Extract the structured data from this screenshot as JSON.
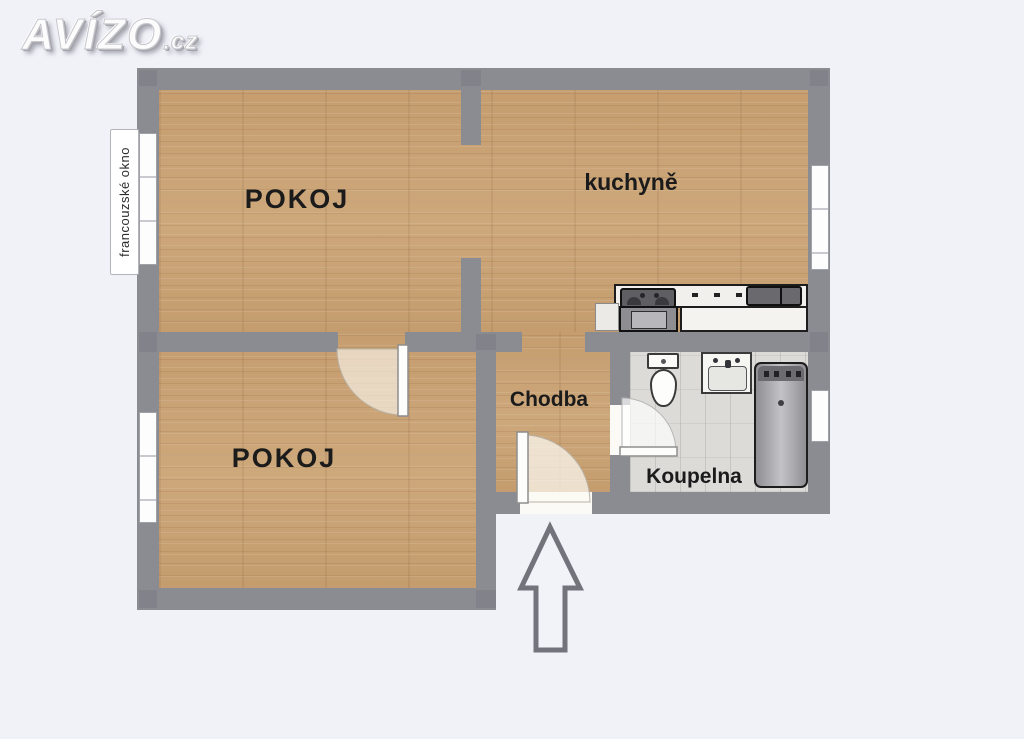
{
  "logo": {
    "name": "AVÍZO",
    "tld": ".cz"
  },
  "plan": {
    "rooms": [
      {
        "id": "pokoj-top",
        "label": "POKOJ"
      },
      {
        "id": "kuchyne",
        "label": "kuchyně"
      },
      {
        "id": "pokoj-bottom",
        "label": "POKOJ"
      },
      {
        "id": "chodba",
        "label": "Chodba"
      },
      {
        "id": "koupelna",
        "label": "Koupelna"
      }
    ],
    "annotations": {
      "french_window": "francouzské okno"
    },
    "colors": {
      "wall": "#8b8b92",
      "wood_floor": "#c7a173",
      "bath_tile": "#dcdbd7",
      "background": "#f1f1f8",
      "outline_black": "#1d1d1d"
    }
  }
}
